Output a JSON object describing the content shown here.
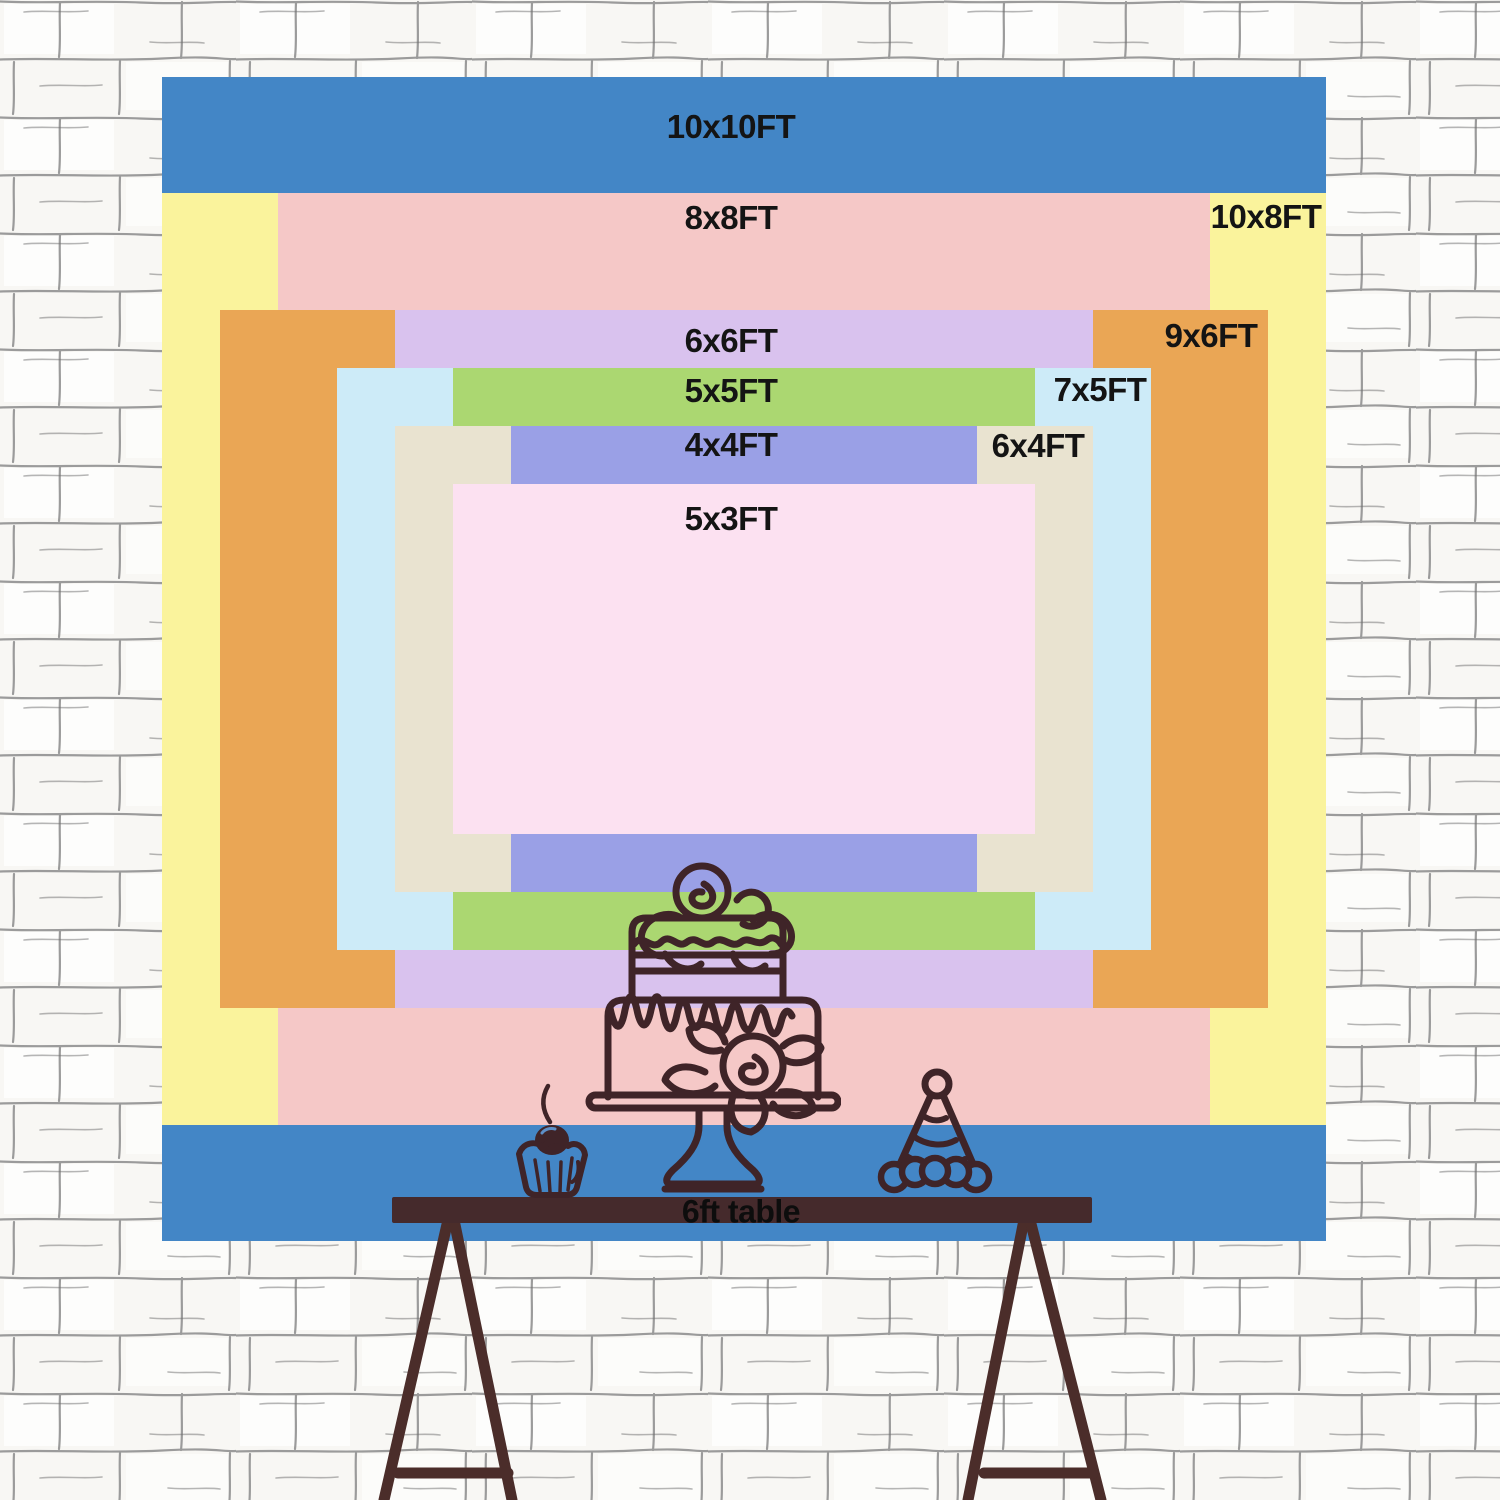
{
  "scene": {
    "description": "backdrop size comparison chart on sketched white brick wall",
    "wall_bg_color": "#f8f7f4",
    "wall_line_color": "#9b9b9b"
  },
  "backdrop": {
    "layout": {
      "px_per_ft": 116.4,
      "center_x": 744,
      "center_y": 659
    },
    "label_color": "#141414",
    "sizes": [
      {
        "id": "10x10ft",
        "label": "10x10FT",
        "width_ft": 10,
        "height_ft": 10,
        "color": "#4386c6",
        "label_x": 731,
        "label_y": 127
      },
      {
        "id": "10x8ft",
        "label": "10x8FT",
        "width_ft": 10,
        "height_ft": 8,
        "color": "#faf39c",
        "label_x": 1266,
        "label_y": 217
      },
      {
        "id": "8x8ft",
        "label": "8x8FT",
        "width_ft": 8,
        "height_ft": 8,
        "color": "#f5c8c7",
        "label_x": 731,
        "label_y": 218
      },
      {
        "id": "9x6ft",
        "label": "9x6FT",
        "width_ft": 9,
        "height_ft": 6,
        "color": "#eaa655",
        "label_x": 1211,
        "label_y": 336
      },
      {
        "id": "6x6ft",
        "label": "6x6FT",
        "width_ft": 6,
        "height_ft": 6,
        "color": "#d9c2ee",
        "label_x": 731,
        "label_y": 341
      },
      {
        "id": "7x5ft",
        "label": "7x5FT",
        "width_ft": 7,
        "height_ft": 5,
        "color": "#cdebf8",
        "label_x": 1100,
        "label_y": 390
      },
      {
        "id": "5x5ft",
        "label": "5x5FT",
        "width_ft": 5,
        "height_ft": 5,
        "color": "#abd771",
        "label_x": 731,
        "label_y": 391
      },
      {
        "id": "6x4ft",
        "label": "6x4FT",
        "width_ft": 6,
        "height_ft": 4,
        "color": "#e9e3d0",
        "label_x": 1038,
        "label_y": 446
      },
      {
        "id": "4x4ft",
        "label": "4x4FT",
        "width_ft": 4,
        "height_ft": 4,
        "color": "#9aa0e6",
        "label_x": 731,
        "label_y": 445
      },
      {
        "id": "5x3ft",
        "label": "5x3FT",
        "width_ft": 5,
        "height_ft": 3,
        "color": "#fce1f1",
        "label_x": 731,
        "label_y": 519
      }
    ]
  },
  "table": {
    "label": "6ft table",
    "top_color": "#452a2c",
    "leg_color": "#4b2d2a"
  },
  "drawings": {
    "stroke_color": "#3f2428",
    "cherry_highlight_color": "#5d8fc7",
    "hat_brim_fill": "#4386c6",
    "items": [
      "cake-icon",
      "cupcake-icon",
      "party-hat-icon"
    ]
  }
}
